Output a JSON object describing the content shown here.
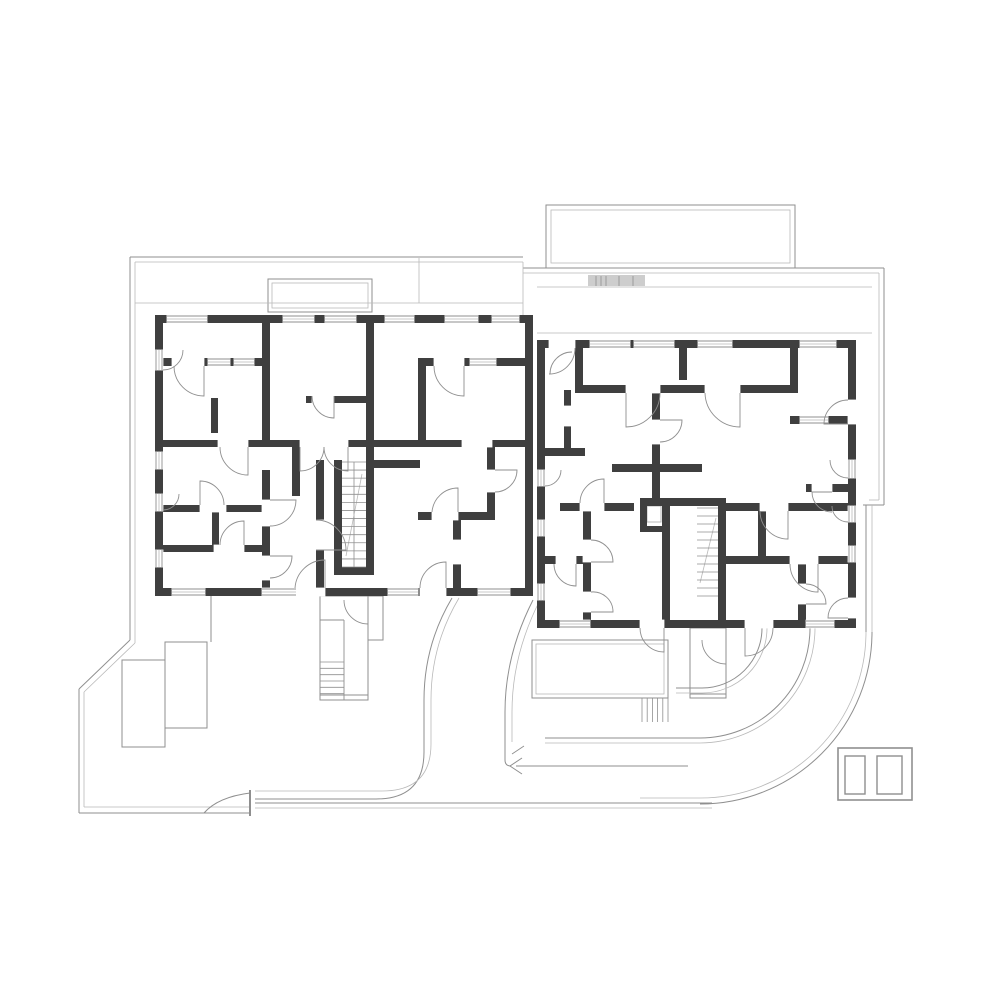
{
  "document": {
    "kind": "architectural-floor-plan",
    "floors_shown": 1,
    "units": 2,
    "visible_text": ""
  },
  "canvas": {
    "w": 1000,
    "h": 1000,
    "bg": "#ffffff"
  },
  "colors": {
    "wall": "#3f3f3f",
    "thin": "#8f8f8f",
    "light": "#b9b9b9",
    "hatch": "#cdcdcd",
    "white": "#ffffff"
  },
  "layers": {
    "fills": [
      [
        588,
        275,
        57,
        11,
        "hatch"
      ]
    ],
    "outlineRects": [
      [
        546,
        205,
        249,
        63,
        1,
        "thin"
      ],
      [
        551,
        210,
        239,
        53,
        0.8,
        "light"
      ],
      [
        268,
        279,
        104,
        33,
        1,
        "thin"
      ],
      [
        272,
        283,
        96,
        25,
        0.8,
        "light"
      ],
      [
        122,
        660,
        43,
        87,
        1,
        "thin"
      ],
      [
        165,
        642,
        42,
        86,
        1,
        "thin"
      ],
      [
        532,
        640,
        136,
        58,
        1,
        "thin"
      ],
      [
        536,
        644,
        128,
        50,
        0.8,
        "light"
      ],
      [
        838,
        748,
        74,
        52,
        1.6,
        "thin"
      ],
      [
        845,
        756,
        20,
        38,
        1.4,
        "thin"
      ],
      [
        877,
        756,
        25,
        38,
        1.4,
        "thin"
      ],
      [
        368,
        596,
        15,
        44,
        1,
        "thin"
      ],
      [
        690,
        628,
        36,
        70,
        1,
        "thin"
      ],
      [
        320,
        596,
        48,
        104,
        1,
        "thin"
      ],
      [
        647,
        506,
        14,
        16,
        1,
        "light"
      ]
    ],
    "lines": [
      [
        130,
        257,
        523,
        257,
        1,
        "thin"
      ],
      [
        135,
        262,
        523,
        262,
        0.8,
        "light"
      ],
      [
        130,
        257,
        130,
        640,
        1,
        "thin"
      ],
      [
        135,
        262,
        135,
        643,
        0.8,
        "light"
      ],
      [
        130,
        640,
        79,
        689,
        1,
        "thin"
      ],
      [
        135,
        643,
        84,
        692,
        0.8,
        "light"
      ],
      [
        79,
        689,
        79,
        813,
        1,
        "thin"
      ],
      [
        84,
        692,
        84,
        807,
        0.8,
        "light"
      ],
      [
        79,
        813,
        250,
        813,
        1,
        "thin"
      ],
      [
        84,
        807,
        250,
        807,
        0.8,
        "light"
      ],
      [
        211,
        596,
        211,
        642,
        1,
        "thin"
      ],
      [
        523,
        268,
        884,
        268,
        1,
        "thin"
      ],
      [
        523,
        273,
        879,
        273,
        0.8,
        "light"
      ],
      [
        884,
        268,
        884,
        505,
        1,
        "thin"
      ],
      [
        879,
        273,
        879,
        500,
        0.8,
        "light"
      ],
      [
        884,
        505,
        863,
        505,
        1,
        "thin"
      ],
      [
        879,
        500,
        869,
        500,
        0.8,
        "light"
      ],
      [
        866,
        505,
        866,
        632,
        1,
        "thin"
      ],
      [
        872,
        505,
        872,
        632,
        0.8,
        "light"
      ],
      [
        537,
        287,
        872,
        287,
        0.8,
        "light"
      ],
      [
        135,
        303,
        523,
        303,
        0.8,
        "light"
      ],
      [
        537,
        333,
        872,
        333,
        0.8,
        "light"
      ],
      [
        419,
        258,
        419,
        303,
        0.8,
        "light"
      ],
      [
        523,
        262,
        523,
        315,
        0.8,
        "light"
      ],
      [
        255,
        803,
        712,
        803,
        1,
        "thin"
      ],
      [
        255,
        808,
        712,
        808,
        0.8,
        "light"
      ],
      [
        516,
        766,
        688,
        766,
        0.9,
        "thin"
      ],
      [
        354,
        462,
        354,
        567,
        0.8,
        "thin"
      ],
      [
        344,
        620,
        344,
        700,
        0.9,
        "thin"
      ],
      [
        320,
        620,
        344,
        620,
        0.9,
        "thin"
      ],
      [
        320,
        695,
        368,
        695,
        0.9,
        "thin"
      ],
      [
        690,
        694,
        726,
        694,
        0.9,
        "thin"
      ],
      [
        596,
        276,
        596,
        286,
        0.8,
        "thin"
      ],
      [
        601,
        276,
        601,
        286,
        0.8,
        "thin"
      ],
      [
        606,
        276,
        606,
        286,
        0.8,
        "thin"
      ],
      [
        619,
        276,
        619,
        286,
        0.8,
        "thin"
      ],
      [
        633,
        276,
        633,
        286,
        0.8,
        "thin"
      ],
      [
        250,
        790,
        250,
        816,
        2,
        "thin"
      ]
    ],
    "paths": [
      [
        "M452,598 Q424,645 424,700 L424,752 Q424,799 376,799 L255,799",
        1,
        "thin"
      ],
      [
        "M459,598 Q431,645 431,700 L431,744 Q431,791 382,791 L255,791",
        0.8,
        "light"
      ],
      [
        "M533,600 Q505,655 505,712 L505,760 Q505,766 511,766",
        1,
        "thin"
      ],
      [
        "M540,600 Q512,655 512,712 L512,742",
        0.8,
        "light"
      ],
      [
        "M872,632 A172,172 0 0 1 700,804",
        1,
        "thin"
      ],
      [
        "M866,632 A166,166 0 0 1 700,798 L640,798",
        0.8,
        "light"
      ],
      [
        "M810,628 A110,110 0 0 1 700,738 L545,738",
        1,
        "thin"
      ],
      [
        "M815,628 A115,115 0 0 1 700,743 L545,743",
        0.8,
        "light"
      ],
      [
        "M762,628 A60,60 0 0 1 702,688 L676,688",
        1,
        "thin"
      ],
      [
        "M767,628 A65,65 0 0 1 702,693 L676,693",
        0.8,
        "light"
      ],
      [
        "M204,813 Q218,797 250,793",
        1,
        "thin"
      ],
      [
        "M346,556 L362,474",
        0.8,
        "light"
      ],
      [
        "M700,583 L716,518",
        0.8,
        "light"
      ],
      [
        "M522,758 L510,766 L522,774",
        1,
        "thin"
      ],
      [
        "M524,746 L512,754",
        0.9,
        "thin"
      ]
    ],
    "walls": [
      [
        155,
        315,
        378,
        8
      ],
      [
        155,
        315,
        8,
        281
      ],
      [
        155,
        588,
        378,
        8
      ],
      [
        525,
        315,
        8,
        281
      ],
      [
        262,
        315,
        8,
        125
      ],
      [
        366,
        315,
        8,
        125
      ],
      [
        418,
        358,
        8,
        82
      ],
      [
        163,
        358,
        99,
        8
      ],
      [
        426,
        358,
        99,
        8
      ],
      [
        163,
        440,
        362,
        7
      ],
      [
        211,
        398,
        7,
        35
      ],
      [
        292,
        441,
        8,
        55
      ],
      [
        306,
        396,
        60,
        7
      ],
      [
        334,
        460,
        8,
        115
      ],
      [
        366,
        447,
        8,
        128
      ],
      [
        334,
        567,
        40,
        8
      ],
      [
        316,
        460,
        8,
        128
      ],
      [
        262,
        470,
        8,
        126
      ],
      [
        163,
        505,
        107,
        7
      ],
      [
        163,
        545,
        107,
        7
      ],
      [
        212,
        512,
        7,
        33
      ],
      [
        487,
        447,
        8,
        73
      ],
      [
        418,
        512,
        77,
        8
      ],
      [
        453,
        520,
        8,
        68
      ],
      [
        374,
        460,
        46,
        8
      ],
      [
        537,
        340,
        319,
        8
      ],
      [
        537,
        340,
        8,
        288
      ],
      [
        537,
        620,
        319,
        8
      ],
      [
        848,
        340,
        8,
        288
      ],
      [
        575,
        340,
        8,
        53
      ],
      [
        575,
        385,
        223,
        8
      ],
      [
        790,
        348,
        8,
        45
      ],
      [
        679,
        348,
        8,
        32
      ],
      [
        652,
        393,
        8,
        79
      ],
      [
        612,
        464,
        90,
        8
      ],
      [
        652,
        472,
        8,
        26
      ],
      [
        560,
        503,
        74,
        8
      ],
      [
        640,
        498,
        86,
        8
      ],
      [
        640,
        498,
        7,
        34
      ],
      [
        640,
        526,
        28,
        6
      ],
      [
        662,
        498,
        8,
        130
      ],
      [
        718,
        498,
        8,
        130
      ],
      [
        583,
        511,
        8,
        117
      ],
      [
        545,
        556,
        46,
        8
      ],
      [
        726,
        503,
        122,
        8
      ],
      [
        758,
        511,
        8,
        49
      ],
      [
        726,
        556,
        122,
        8
      ],
      [
        798,
        564,
        8,
        64
      ],
      [
        806,
        484,
        42,
        8
      ],
      [
        790,
        416,
        58,
        8
      ],
      [
        545,
        448,
        40,
        8
      ],
      [
        564,
        390,
        7,
        58
      ]
    ],
    "gaps": [
      [
        172,
        358,
        32,
        8
      ],
      [
        434,
        358,
        30,
        8
      ],
      [
        218,
        440,
        30,
        7
      ],
      [
        300,
        440,
        48,
        7
      ],
      [
        462,
        440,
        30,
        7
      ],
      [
        295,
        588,
        30,
        8
      ],
      [
        420,
        588,
        26,
        8
      ],
      [
        262,
        500,
        8,
        26
      ],
      [
        262,
        556,
        8,
        24
      ],
      [
        316,
        520,
        8,
        30
      ],
      [
        200,
        505,
        26,
        7
      ],
      [
        214,
        545,
        30,
        7
      ],
      [
        487,
        470,
        8,
        22
      ],
      [
        432,
        512,
        26,
        8
      ],
      [
        453,
        540,
        8,
        24
      ],
      [
        312,
        396,
        22,
        7
      ],
      [
        549,
        340,
        26,
        8
      ],
      [
        626,
        385,
        34,
        8
      ],
      [
        705,
        385,
        35,
        8
      ],
      [
        580,
        503,
        24,
        8
      ],
      [
        583,
        540,
        8,
        22
      ],
      [
        583,
        592,
        8,
        20
      ],
      [
        760,
        503,
        28,
        8
      ],
      [
        790,
        556,
        28,
        8
      ],
      [
        798,
        584,
        8,
        20
      ],
      [
        564,
        406,
        7,
        20
      ],
      [
        848,
        400,
        8,
        24
      ],
      [
        848,
        598,
        8,
        20
      ],
      [
        640,
        620,
        24,
        8
      ],
      [
        745,
        620,
        28,
        8
      ],
      [
        652,
        420,
        8,
        24
      ],
      [
        556,
        556,
        20,
        8
      ],
      [
        812,
        484,
        20,
        8
      ]
    ],
    "windows": [
      [
        167,
        315,
        40,
        8,
        "h"
      ],
      [
        283,
        315,
        31,
        8,
        "h"
      ],
      [
        325,
        315,
        31,
        8,
        "h"
      ],
      [
        385,
        315,
        29,
        8,
        "h"
      ],
      [
        445,
        315,
        33,
        8,
        "h"
      ],
      [
        492,
        315,
        27,
        8,
        "h"
      ],
      [
        155,
        350,
        8,
        20,
        "v"
      ],
      [
        155,
        452,
        8,
        17,
        "v"
      ],
      [
        155,
        494,
        8,
        17,
        "v"
      ],
      [
        155,
        550,
        8,
        17,
        "v"
      ],
      [
        172,
        588,
        33,
        8,
        "h"
      ],
      [
        262,
        588,
        34,
        8,
        "h"
      ],
      [
        388,
        588,
        30,
        8,
        "h"
      ],
      [
        478,
        588,
        32,
        8,
        "h"
      ],
      [
        208,
        358,
        22,
        8,
        "h"
      ],
      [
        234,
        358,
        20,
        8,
        "h"
      ],
      [
        470,
        358,
        26,
        8,
        "h"
      ],
      [
        590,
        340,
        40,
        8,
        "h"
      ],
      [
        634,
        340,
        40,
        8,
        "h"
      ],
      [
        698,
        340,
        34,
        8,
        "h"
      ],
      [
        800,
        340,
        36,
        8,
        "h"
      ],
      [
        537,
        470,
        8,
        16,
        "v"
      ],
      [
        537,
        520,
        8,
        16,
        "v"
      ],
      [
        537,
        584,
        8,
        16,
        "v"
      ],
      [
        848,
        460,
        8,
        18,
        "v"
      ],
      [
        848,
        506,
        8,
        16,
        "v"
      ],
      [
        848,
        546,
        8,
        16,
        "v"
      ],
      [
        560,
        620,
        30,
        8,
        "h"
      ],
      [
        806,
        620,
        28,
        8,
        "h"
      ],
      [
        800,
        416,
        28,
        8,
        "h"
      ]
    ],
    "stairs": [
      [
        342,
        462,
        24,
        105,
        13,
        "h"
      ],
      [
        320,
        662,
        24,
        38,
        6,
        "h"
      ],
      [
        697,
        508,
        21,
        88,
        11,
        "h"
      ],
      [
        642,
        698,
        26,
        24,
        5,
        "v"
      ]
    ],
    "doors": [
      "M204,366 L204,396 A30,30 0 0 1 174,366",
      "M464,366 L464,396 A30,30 0 0 1 434,366",
      "M300,447 L300,471 A24,24 0 0 0 324,447",
      "M348,447 L348,471 A24,24 0 0 1 324,447",
      "M248,447 L248,475 A28,28 0 0 1 220,447",
      "M325,588 L325,560 A30,30 0 0 0 295,588",
      "M446,588 L446,562 A26,26 0 0 0 420,588",
      "M270,500 L296,500 A26,26 0 0 1 270,526",
      "M270,556 L292,556 A22,22 0 0 1 270,578",
      "M200,505 L200,481 A24,24 0 0 1 224,505",
      "M244,545 L244,521 A24,24 0 0 0 220,545",
      "M334,396 L334,418 A22,22 0 0 1 312,396",
      "M495,470 L517,470 A22,22 0 0 1 495,492",
      "M458,512 L458,488 A26,26 0 0 0 432,512",
      "M316,550 L346,550 A30,30 0 0 0 316,520",
      "M344,600 A24,24 0 0 0 368,624",
      "M163,370 A20,20 0 0 0 183,350",
      "M163,510 A16,16 0 0 0 179,494",
      "M549,374 A26,26 0 0 0 575,348",
      "M572,352 A22,22 0 0 0 550,374",
      "M626,393 L626,427 A34,34 0 0 0 660,393",
      "M740,393 L740,427 A35,35 0 0 1 705,393",
      "M660,420 L682,420 A22,22 0 0 1 660,442",
      "M604,503 L604,479 A24,24 0 0 0 580,503",
      "M591,562 L613,562 A22,22 0 0 0 591,540",
      "M591,612 L613,612 A20,20 0 0 0 591,592",
      "M788,511 L788,539 A28,28 0 0 1 760,511",
      "M818,564 L818,592 A28,28 0 0 1 790,564",
      "M806,604 L826,604 A20,20 0 0 0 806,584",
      "M848,424 L824,424 A24,24 0 0 1 848,400",
      "M848,618 L828,618 A20,20 0 0 1 848,598",
      "M664,628 L664,652 A24,24 0 0 1 640,628",
      "M745,628 L745,656 A28,28 0 0 0 773,628",
      "M702,640 A24,24 0 0 0 726,664",
      "M576,564 L576,586 A22,22 0 0 1 554,564",
      "M832,492 L812,492 A20,20 0 0 0 832,512",
      "M848,478 A18,18 0 0 1 830,460",
      "M848,522 A16,16 0 0 1 832,506",
      "M545,486 A16,16 0 0 0 561,470"
    ]
  }
}
